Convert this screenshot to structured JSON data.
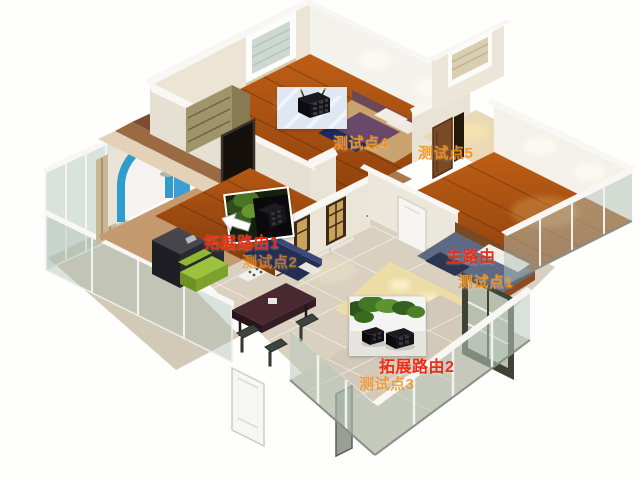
{
  "scene": {
    "description": "3D isometric apartment floor plan showing Wi-Fi router placement and signal test points",
    "background_color": "#ffffff"
  },
  "colors": {
    "router_label_red": "#ee2c16",
    "test_point_orange": "#f19120",
    "wood_floor": "#a84e12",
    "tile_floor": "#d9d0c0",
    "wall_top": "#f8f7f4",
    "blue_arch": "#2f9ccc"
  },
  "labels": {
    "main_router": {
      "text": "主路由",
      "color": "#ee2c16"
    },
    "extender_1": {
      "text": "拓展路由1",
      "color": "#ee2c16"
    },
    "extender_2": {
      "text": "拓展路由2",
      "color": "#ee2c16"
    },
    "test_point_1": {
      "text": "测试点1",
      "color": "#f19120"
    },
    "test_point_2": {
      "text": "测试点2",
      "color": "#f19120"
    },
    "test_point_3": {
      "text": "测试点3",
      "color": "#f19120"
    },
    "test_point_4": {
      "text": "测试点4",
      "color": "#f19120"
    },
    "test_point_5": {
      "text": "测试点5",
      "color": "#f19120"
    }
  },
  "callout_photos": [
    {
      "name": "router-photo-top-bedroom",
      "depicts": "black cube router on desk"
    },
    {
      "name": "router-photo-extender-1",
      "depicts": "black cube router beside plant"
    },
    {
      "name": "router-photo-extender-2",
      "depicts": "two black cube routers beside plant"
    }
  ]
}
